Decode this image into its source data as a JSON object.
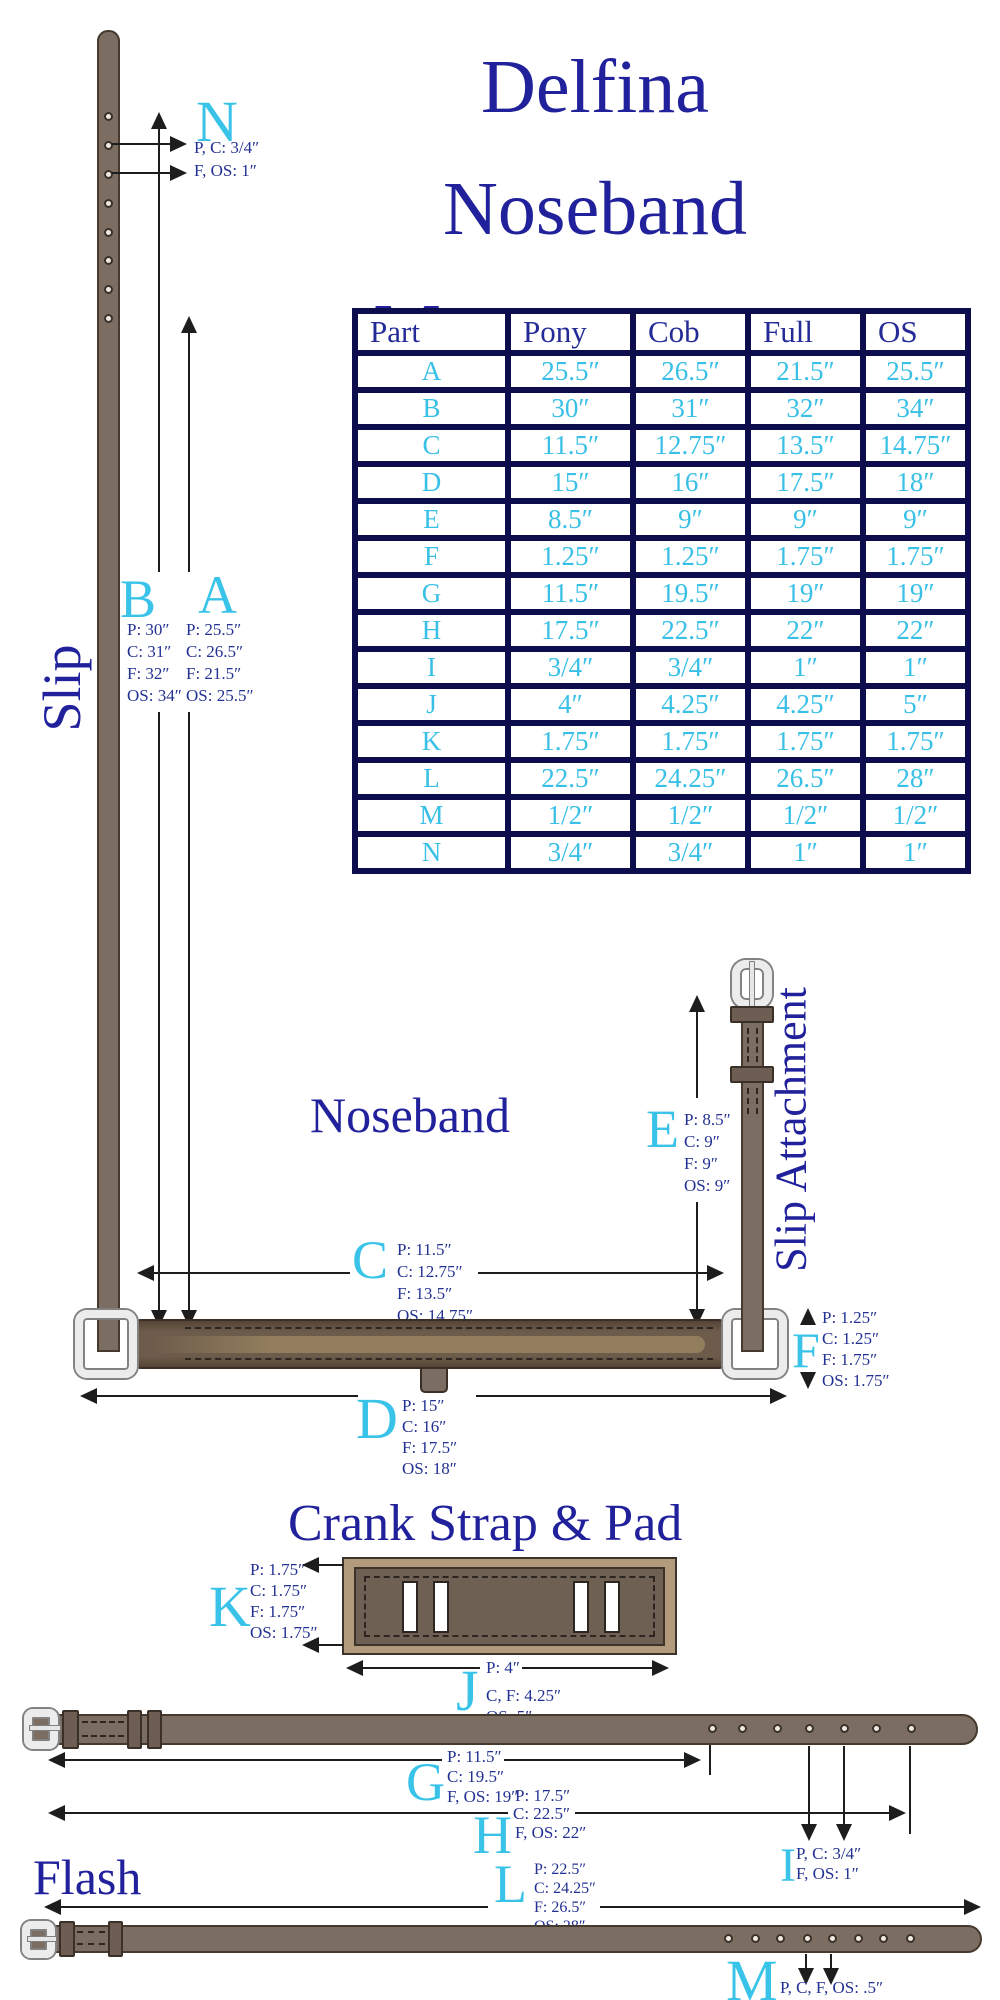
{
  "header": {
    "title_lines": [
      "Delfina",
      "Noseband",
      "Measurements"
    ]
  },
  "colors": {
    "accent_cyan": "#3ac3e8",
    "navy_text": "#21219c",
    "dim_text_navy": "#233193",
    "table_border_navy": "#0d0d4e",
    "strap_brown": "#7c6d63"
  },
  "table": {
    "headers": [
      "Part",
      "Pony",
      "Cob",
      "Full",
      "OS"
    ],
    "rows": [
      {
        "part": "A",
        "values": [
          "25.5″",
          "26.5″",
          "21.5″",
          "25.5″"
        ]
      },
      {
        "part": "B",
        "values": [
          "30″",
          "31″",
          "32″",
          "34″"
        ]
      },
      {
        "part": "C",
        "values": [
          "11.5″",
          "12.75″",
          "13.5″",
          "14.75″"
        ]
      },
      {
        "part": "D",
        "values": [
          "15″",
          "16″",
          "17.5″",
          "18″"
        ]
      },
      {
        "part": "E",
        "values": [
          "8.5″",
          "9″",
          "9″",
          "9″"
        ]
      },
      {
        "part": "F",
        "values": [
          "1.25″",
          "1.25″",
          "1.75″",
          "1.75″"
        ]
      },
      {
        "part": "G",
        "values": [
          "11.5″",
          "19.5″",
          "19″",
          "19″"
        ]
      },
      {
        "part": "H",
        "values": [
          "17.5″",
          "22.5″",
          "22″",
          "22″"
        ]
      },
      {
        "part": "I",
        "values": [
          "3/4″",
          "3/4″",
          "1″",
          "1″"
        ]
      },
      {
        "part": "J",
        "values": [
          "4″",
          "4.25″",
          "4.25″",
          "5″"
        ]
      },
      {
        "part": "K",
        "values": [
          "1.75″",
          "1.75″",
          "1.75″",
          "1.75″"
        ]
      },
      {
        "part": "L",
        "values": [
          "22.5″",
          "24.25″",
          "26.5″",
          "28″"
        ]
      },
      {
        "part": "M",
        "values": [
          "1/2″",
          "1/2″",
          "1/2″",
          "1/2″"
        ]
      },
      {
        "part": "N",
        "values": [
          "3/4″",
          "3/4″",
          "1″",
          "1″"
        ]
      }
    ]
  },
  "slip": {
    "title": "Slip",
    "n": {
      "letter": "N",
      "lines": [
        "P, C: 3/4″",
        "F, OS: 1″"
      ]
    },
    "b": {
      "letter": "B",
      "lines": [
        "P: 30″",
        "C: 31″",
        "F: 32″",
        "OS: 34″"
      ]
    },
    "a": {
      "letter": "A",
      "lines": [
        "P: 25.5″",
        "C: 26.5″",
        "F: 21.5″",
        "OS: 25.5″"
      ]
    }
  },
  "noseband": {
    "title": "Noseband",
    "c": {
      "letter": "C",
      "lines": [
        "P: 11.5″",
        "C: 12.75″",
        "F: 13.5″",
        "OS: 14.75″"
      ]
    },
    "d": {
      "letter": "D",
      "lines": [
        "P: 15″",
        "C: 16″",
        "F: 17.5″",
        "OS: 18″"
      ]
    },
    "e": {
      "letter": "E",
      "lines": [
        "P: 8.5″",
        "C: 9″",
        "F: 9″",
        "OS: 9″"
      ]
    },
    "f": {
      "letter": "F",
      "lines": [
        "P: 1.25″",
        "C: 1.25″",
        "F: 1.75″",
        "OS: 1.75″"
      ]
    }
  },
  "slip_attachment": {
    "title": "Slip Attachment"
  },
  "crank": {
    "title": "Crank Strap & Pad",
    "k": {
      "letter": "K",
      "lines": [
        "P: 1.75″",
        "C: 1.75″",
        "F: 1.75″",
        "OS: 1.75″"
      ]
    },
    "j": {
      "letter": "J",
      "lines": [
        "P: 4″",
        "C, F: 4.25″",
        "OS: 5″"
      ]
    }
  },
  "flash": {
    "title": "Flash",
    "g": {
      "letter": "G",
      "lines": [
        "P: 11.5″",
        "C: 19.5″",
        "F, OS: 19″"
      ]
    },
    "h": {
      "letter": "H",
      "lines": [
        "P: 17.5″",
        "C: 22.5″",
        "F, OS:  22″"
      ]
    },
    "i": {
      "letter": "I",
      "lines": [
        "P, C: 3/4″",
        "F, OS: 1″"
      ]
    },
    "l": {
      "letter": "L",
      "lines": [
        "P: 22.5″",
        "C: 24.25″",
        "F: 26.5″",
        "OS: 28″"
      ]
    },
    "m": {
      "letter": "M",
      "lines": [
        "P, C, F, OS: .5″"
      ]
    }
  }
}
